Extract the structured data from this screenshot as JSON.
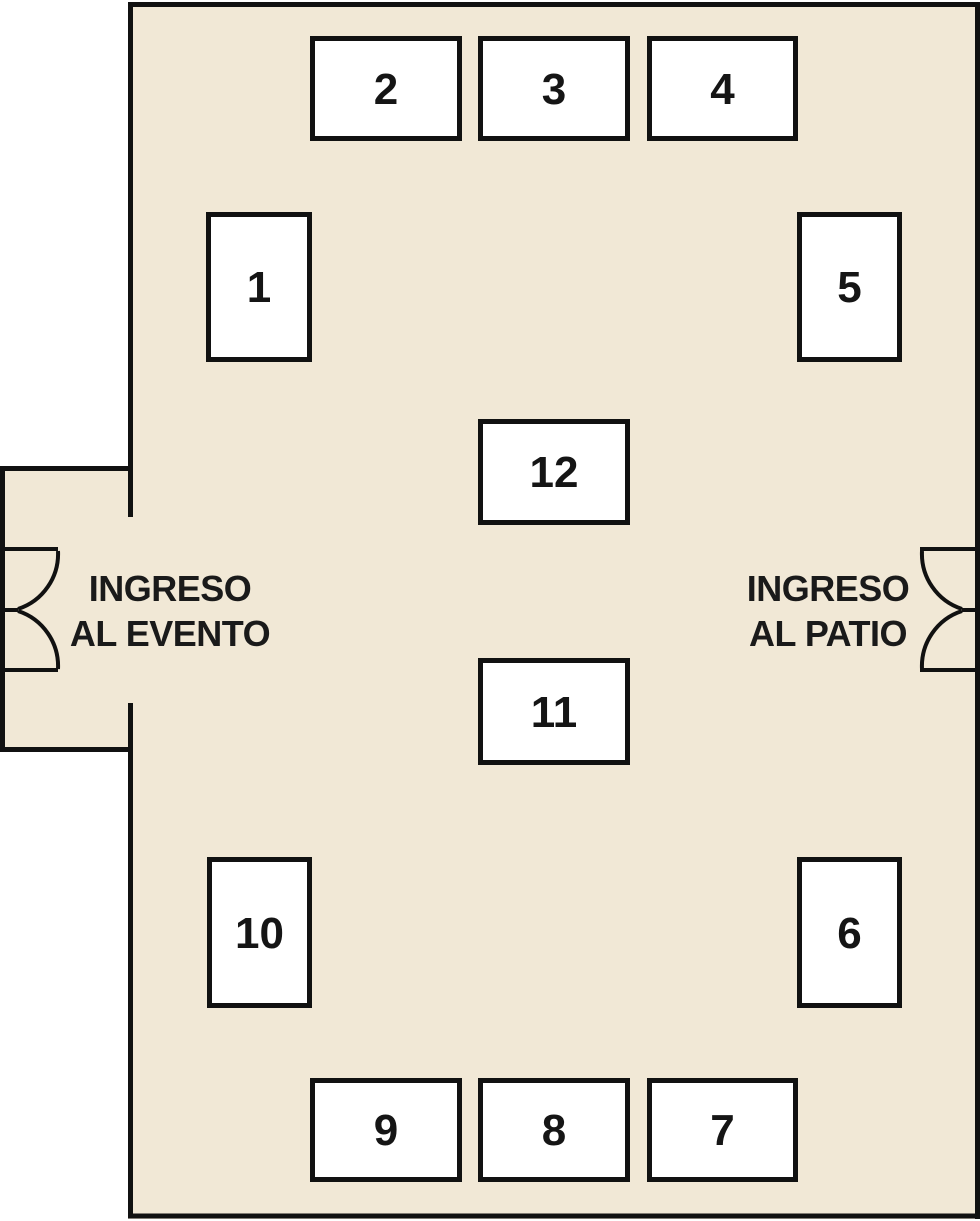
{
  "plan": {
    "colors": {
      "floor": "#f1e8d6",
      "wall": "#111111",
      "booth_fill": "#ffffff",
      "text": "#1a1a1a",
      "outside": "#ffffff"
    },
    "booths": [
      {
        "label": "1",
        "x": 206,
        "y": 212,
        "w": 106,
        "h": 150
      },
      {
        "label": "2",
        "x": 310,
        "y": 36,
        "w": 152,
        "h": 105
      },
      {
        "label": "3",
        "x": 478,
        "y": 36,
        "w": 152,
        "h": 105
      },
      {
        "label": "4",
        "x": 647,
        "y": 36,
        "w": 151,
        "h": 105
      },
      {
        "label": "5",
        "x": 797,
        "y": 212,
        "w": 105,
        "h": 150
      },
      {
        "label": "6",
        "x": 797,
        "y": 857,
        "w": 105,
        "h": 151
      },
      {
        "label": "7",
        "x": 647,
        "y": 1078,
        "w": 151,
        "h": 104
      },
      {
        "label": "8",
        "x": 478,
        "y": 1078,
        "w": 152,
        "h": 104
      },
      {
        "label": "9",
        "x": 310,
        "y": 1078,
        "w": 152,
        "h": 104
      },
      {
        "label": "10",
        "x": 207,
        "y": 857,
        "w": 105,
        "h": 151
      },
      {
        "label": "11",
        "x": 478,
        "y": 658,
        "w": 152,
        "h": 107
      },
      {
        "label": "12",
        "x": 478,
        "y": 419,
        "w": 152,
        "h": 106
      }
    ],
    "entrances": [
      {
        "line1": "INGRESO",
        "line2": "AL EVENTO",
        "x": 52,
        "y": 563,
        "w": 236,
        "h": 95
      },
      {
        "line1": "INGRESO",
        "line2": "AL PATIO",
        "x": 710,
        "y": 563,
        "w": 236,
        "h": 95
      }
    ]
  }
}
